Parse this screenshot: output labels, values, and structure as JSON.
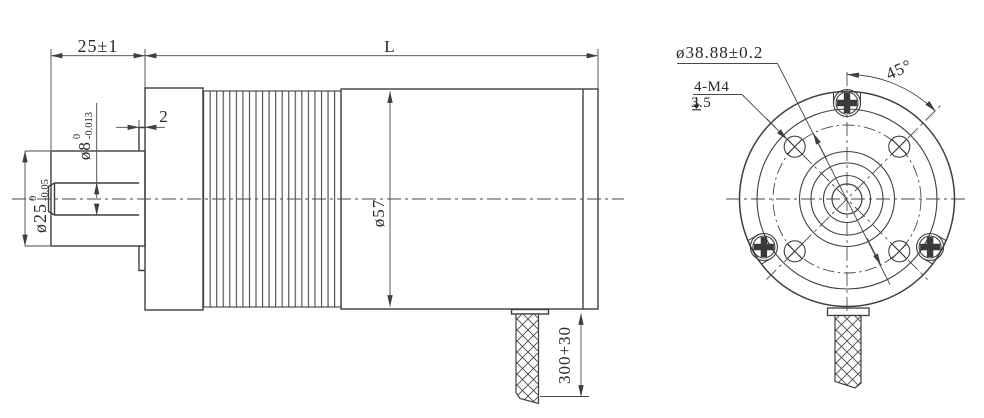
{
  "meta": {
    "background": "#ffffff",
    "line_color": "#3f3f3f",
    "text_color": "#2a2a2a",
    "drawing_type": "motor outline dimension drawing"
  },
  "side_view": {
    "boss_length": "25±1",
    "body_length": "L",
    "pilot_step": "2",
    "shaft_dia_main": "ø8",
    "shaft_dia_tol_upper": "0",
    "shaft_dia_tol_lower": "-0.013",
    "boss_dia_main": "ø25",
    "boss_dia_tol_upper": "0",
    "boss_dia_tol_lower": "-0.05",
    "body_dia": "ø57",
    "cable_length": "300+30"
  },
  "front_view": {
    "bolt_circle_dia": "ø38.88±0.2",
    "mount_holes": "4-M4",
    "mount_hole_depth": "3.5",
    "mount_hole_angle": "45°"
  }
}
